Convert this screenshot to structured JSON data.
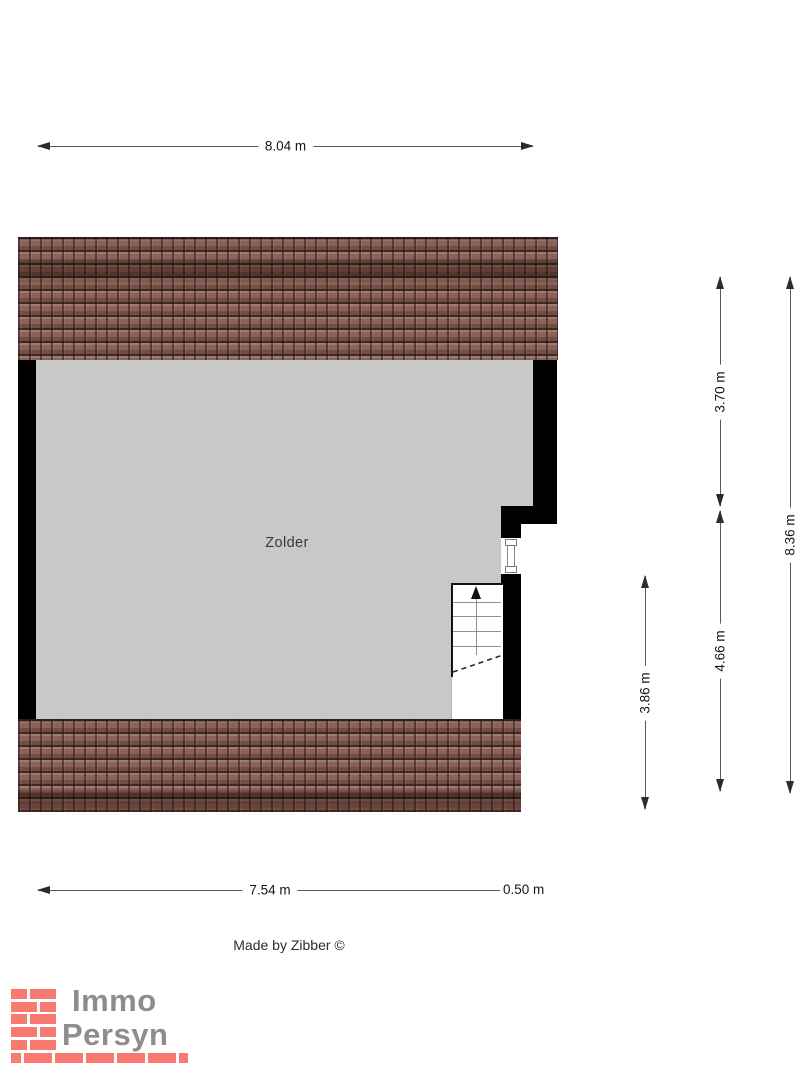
{
  "floorplan": {
    "room_label": "Zolder",
    "credit": "Made by Zibber ©",
    "dimensions": {
      "width_total": "8.04 m",
      "width_main": "7.54 m",
      "width_offset": "0.50 m",
      "height_upper": "3.70 m",
      "height_lower": "4.66 m",
      "height_total": "8.36 m",
      "height_stair_zone": "3.86 m"
    },
    "colors": {
      "floor_fill": "#c8c8c8",
      "wall_fill": "#000000",
      "roof_tile": "#8d6156",
      "dimension_line": "#5a5a5a",
      "logo_brick": "#f8796f",
      "logo_text": "#8d8d8d"
    },
    "icons": {
      "stairs_direction": "up-arrow"
    }
  },
  "logo": {
    "line1": "Immo",
    "line2": "Persyn"
  }
}
